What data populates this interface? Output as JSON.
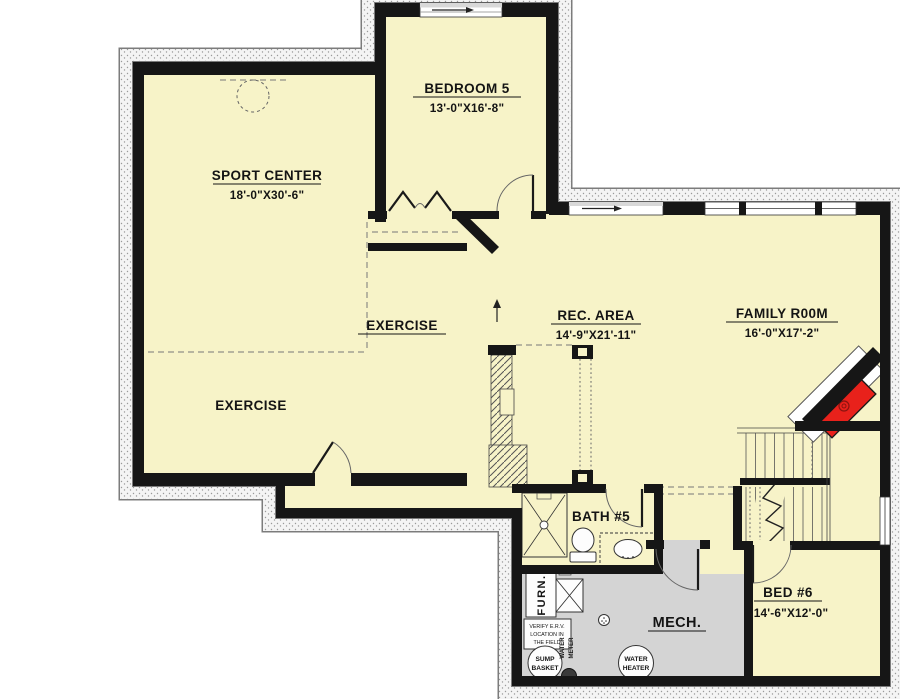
{
  "title": "Basement Floor Plan",
  "colors": {
    "floor": "#f7f3c8",
    "mech_floor": "#d4d4d4",
    "wall": "#161616",
    "fireplace": "#e8211b",
    "background": "#ffffff"
  },
  "rooms": {
    "sport_center": {
      "name": "SPORT CENTER",
      "dims": "18'-0\"X30'-6\""
    },
    "bedroom5": {
      "name": "BEDROOM 5",
      "dims": "13'-0\"X16'-8\""
    },
    "exercise_upper": {
      "name": "EXERCISE"
    },
    "exercise_lower": {
      "name": "EXERCISE"
    },
    "rec_area": {
      "name": "REC. AREA",
      "dims": "14'-9\"X21'-11\""
    },
    "family_room": {
      "name": "FAMILY R00M",
      "dims": "16'-0\"X17'-2\""
    },
    "bath5": {
      "name": "BATH #5"
    },
    "bed6": {
      "name": "BED #6",
      "dims": "14'-6\"X12'-0\""
    },
    "mech": {
      "name": "MECH."
    }
  },
  "equipment": {
    "furnace": "FURN.",
    "sump": [
      "SUMP",
      "BASKET"
    ],
    "water_meter": [
      "WATER",
      "METER"
    ],
    "water_heater": [
      "WATER",
      "HEATER"
    ],
    "note": [
      "VERIFY E.R.V.",
      "LOCATION IN",
      "THE FIELD"
    ]
  }
}
